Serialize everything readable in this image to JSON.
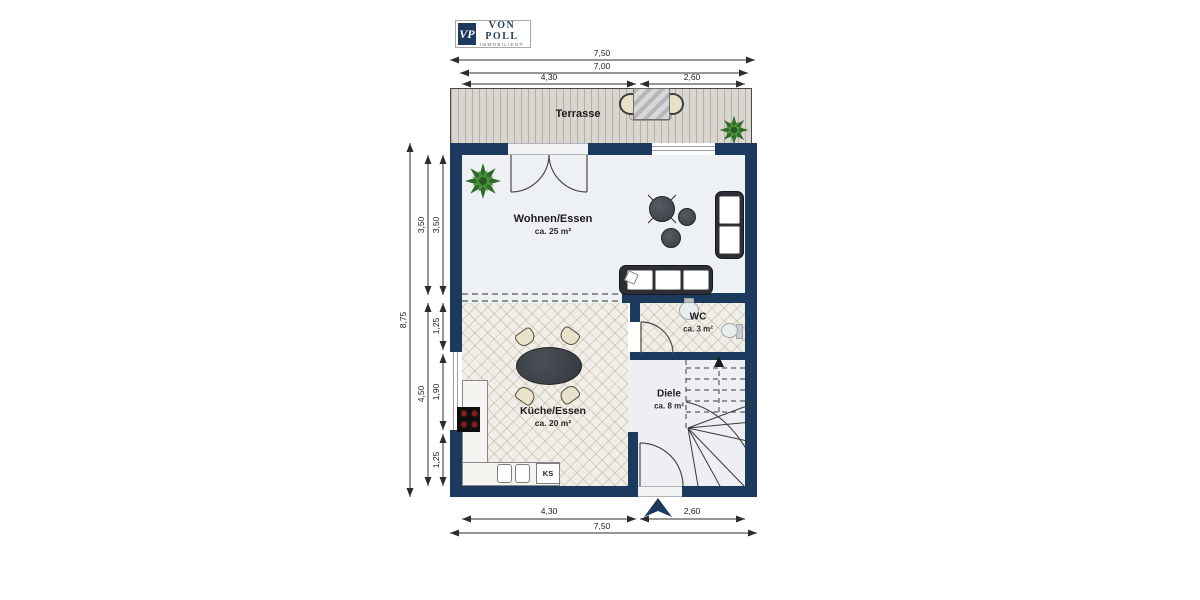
{
  "brand": {
    "monogram": "VP",
    "name": "VON POLL",
    "subtitle": "IMMOBILIEN®"
  },
  "rooms": {
    "terrace": {
      "label": "Terrasse"
    },
    "living": {
      "label": "Wohnen/Essen",
      "area": "ca. 25 m²"
    },
    "kitchen": {
      "label": "Küche/Essen",
      "area": "ca. 20 m²"
    },
    "wc": {
      "label": "WC",
      "area": "ca. 3 m²"
    },
    "hall": {
      "label": "Diele",
      "area": "ca. 8 m²"
    }
  },
  "appliances": {
    "fridge": "KS"
  },
  "dimensions": {
    "top_total": "7,50",
    "top_inner": "7,00",
    "top_left": "4,30",
    "top_right": "2,60",
    "bottom_left": "4,30",
    "bottom_right": "2,60",
    "bottom_total": "7,50",
    "left_total": "8,75",
    "left_living": "3,50",
    "left_living_inner": "3,50",
    "left_kitchen": "4,50",
    "left_seg1": "1,25",
    "left_window": "1,90",
    "left_seg2": "1,25"
  },
  "colors": {
    "wall": "#1c3a5e",
    "deck": "#d9d5cf",
    "tile": "#f1eee8",
    "living_floor": "#eef1f4",
    "plant_green": "#2e6b28",
    "dim_line": "#2c2c2c"
  }
}
